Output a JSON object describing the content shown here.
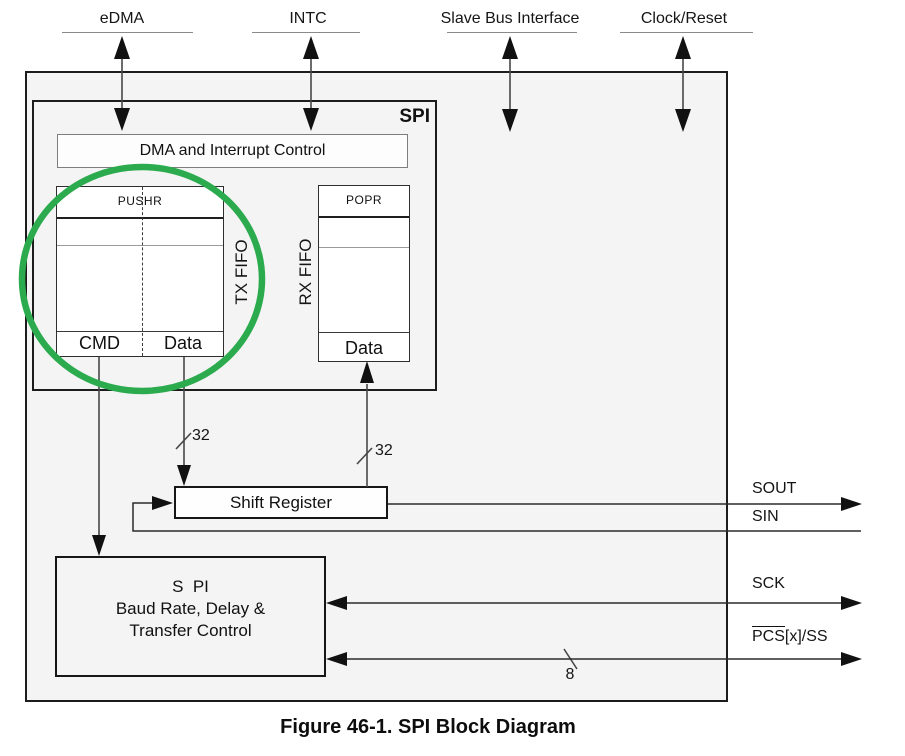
{
  "caption": "Figure 46-1. SPI Block Diagram",
  "top_buses": [
    {
      "label": "eDMA"
    },
    {
      "label": "INTC"
    },
    {
      "label": "Slave Bus Interface"
    },
    {
      "label": "Clock/Reset"
    }
  ],
  "spi_block": {
    "title": "SPI",
    "dma_interrupt_label": "DMA and Interrupt Control",
    "tx_fifo": {
      "register": "PUSHR",
      "side_label": "TX FIFO",
      "cmd_label": "CMD",
      "data_label": "Data"
    },
    "rx_fifo": {
      "register": "POPR",
      "side_label": "RX FIFO",
      "data_label": "Data"
    }
  },
  "shift_register_label": "Shift Register",
  "baud_control": {
    "line1": "S  PI",
    "line2": "Baud Rate, Delay &",
    "line3": "Transfer Control"
  },
  "bus_widths": {
    "tx": "32",
    "rx": "32",
    "pcs": "8"
  },
  "signals": {
    "sout": "SOUT",
    "sin": "SIN",
    "sck": "SCK",
    "pcs_overlined": "PCS",
    "pcs_suffix": "[x]/SS"
  },
  "annotation": {
    "highlight_color": "#2cab4e"
  }
}
